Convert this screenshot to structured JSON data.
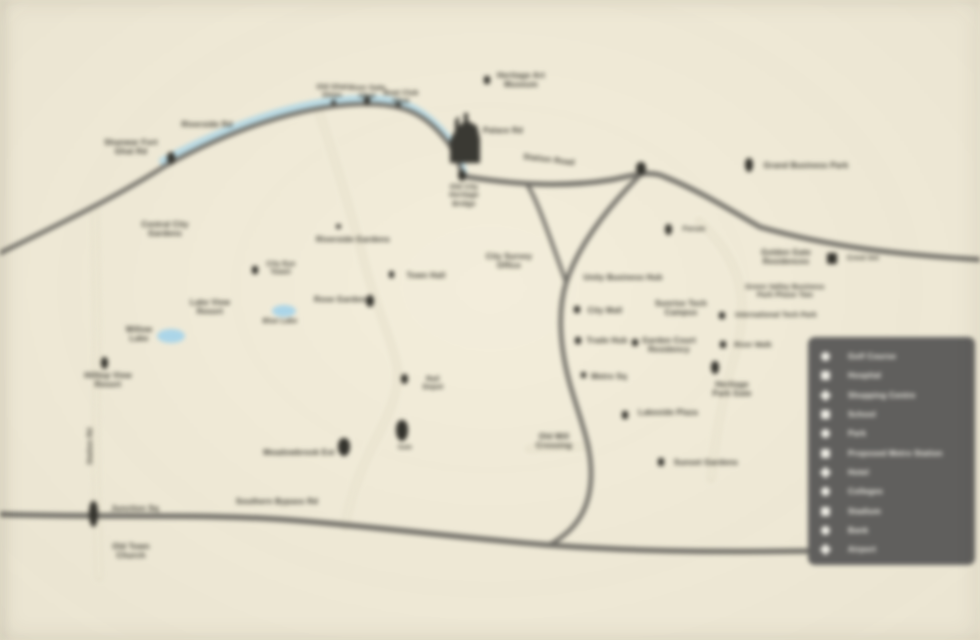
{
  "colors": {
    "background": "#f4eeda",
    "river": "#b9d9e3",
    "lake": "#abd5e8",
    "road_dark": "#716f68",
    "road_light_edge": "#ddd6c0",
    "road_light_core": "#f1ecd9",
    "ink": "#3c3b33",
    "marker": "#33322c",
    "building": "#3a3933",
    "legend_bg": "#605f5d",
    "legend_ink": "#f0eee6"
  },
  "map": {
    "note": "location map, all label text blurred/illegible in source",
    "lakes": [
      {
        "cx": 171,
        "cy": 336,
        "rx": 14,
        "ry": 7
      },
      {
        "cx": 284,
        "cy": 311,
        "rx": 12,
        "ry": 6
      }
    ],
    "labels": [
      {
        "cx": 131,
        "y": 138,
        "text": "Shanwar Fort\nGhat Rd"
      },
      {
        "cx": 207,
        "y": 120,
        "text": "Riverside Rd"
      },
      {
        "cx": 165,
        "y": 220,
        "text": "Central City\nGardens"
      },
      {
        "cx": 332,
        "y": 84,
        "text": "Old Ghat\nSteps",
        "size": 7
      },
      {
        "cx": 367,
        "y": 85,
        "text": "River Gate\nGhat",
        "size": 7
      },
      {
        "cx": 401,
        "y": 90,
        "text": "Boat Club\nGhat",
        "size": 7
      },
      {
        "cx": 521,
        "y": 71,
        "text": "Heritage Art\nMuseum"
      },
      {
        "cx": 503,
        "y": 126,
        "text": "Palace Rd"
      },
      {
        "cx": 464,
        "y": 184,
        "text": "Old City\nHeritage\nBridge",
        "size": 7
      },
      {
        "cx": 549,
        "y": 155,
        "text": "Station Road",
        "rot": 7
      },
      {
        "cx": 806,
        "y": 161,
        "text": "Grand Business Park"
      },
      {
        "cx": 509,
        "y": 252,
        "text": "City Survey\nOffice"
      },
      {
        "cx": 353,
        "y": 235,
        "text": "Riverside Gardens"
      },
      {
        "cx": 426,
        "y": 271,
        "text": "Town Hall"
      },
      {
        "cx": 340,
        "y": 295,
        "text": "Rose Garden"
      },
      {
        "cx": 210,
        "y": 298,
        "text": "Lake View\nResort"
      },
      {
        "cx": 139,
        "y": 325,
        "text": "Willow\nLake"
      },
      {
        "cx": 280,
        "y": 318,
        "text": "Blue Lake",
        "size": 7
      },
      {
        "cx": 108,
        "y": 371,
        "text": "Hilltop View\nResort"
      },
      {
        "cx": 623,
        "y": 273,
        "text": "Unity Business Hub"
      },
      {
        "cx": 605,
        "y": 306,
        "text": "City Mall"
      },
      {
        "cx": 607,
        "y": 336,
        "text": "Trade Hub"
      },
      {
        "cx": 669,
        "y": 336,
        "text": "Garden Court\nResidency"
      },
      {
        "cx": 681,
        "y": 299,
        "text": "Sunrise Tech\nCampus"
      },
      {
        "cx": 609,
        "y": 372,
        "text": "Metro Sq"
      },
      {
        "cx": 732,
        "y": 380,
        "text": "Heritage\nPark Gate"
      },
      {
        "cx": 785,
        "y": 284,
        "text": "Green Valley Business\nPark Phase Two",
        "size": 7
      },
      {
        "cx": 786,
        "y": 248,
        "text": "Golden Gate\nResidences"
      },
      {
        "cx": 863,
        "y": 255,
        "text": "Crest Inn",
        "size": 7
      },
      {
        "cx": 776,
        "y": 312,
        "text": "International Tech Park",
        "size": 7
      },
      {
        "cx": 753,
        "y": 342,
        "text": "River Walk",
        "size": 7
      },
      {
        "cx": 668,
        "y": 408,
        "text": "Lakeside Plaza"
      },
      {
        "cx": 706,
        "y": 458,
        "text": "Sunset Gardens"
      },
      {
        "cx": 554,
        "y": 432,
        "text": "Old Mill\nCrossing"
      },
      {
        "cx": 433,
        "y": 376,
        "text": "Rail\nDepot",
        "size": 7
      },
      {
        "cx": 405,
        "y": 445,
        "text": "Gate",
        "size": 6
      },
      {
        "cx": 299,
        "y": 448,
        "text": "Meadowbrook Est"
      },
      {
        "cx": 277,
        "y": 497,
        "text": "Southern Bypass Rd"
      },
      {
        "cx": 135,
        "y": 504,
        "text": "Junction Sq"
      },
      {
        "cx": 131,
        "y": 542,
        "text": "Old Town\nChurch"
      },
      {
        "cx": 91,
        "y": 442,
        "text": "Station Rd",
        "size": 7,
        "rot": -90
      },
      {
        "cx": 694,
        "y": 226,
        "text": "Forum",
        "size": 7
      },
      {
        "cx": 281,
        "y": 261,
        "text": "City Eye\nTower",
        "size": 7
      }
    ],
    "markers": [
      {
        "x": 167,
        "y": 152,
        "w": 8,
        "h": 12,
        "s": "pin"
      },
      {
        "x": 331,
        "y": 100,
        "w": 5,
        "h": 5,
        "s": "dot"
      },
      {
        "x": 364,
        "y": 96,
        "w": 6,
        "h": 9,
        "s": "pin"
      },
      {
        "x": 396,
        "y": 102,
        "w": 5,
        "h": 5,
        "s": "dot"
      },
      {
        "x": 484,
        "y": 76,
        "w": 6,
        "h": 8,
        "s": "sq"
      },
      {
        "x": 458,
        "y": 170,
        "w": 8,
        "h": 11,
        "s": "pin"
      },
      {
        "x": 636,
        "y": 162,
        "w": 10,
        "h": 13,
        "s": "pin"
      },
      {
        "x": 745,
        "y": 158,
        "w": 8,
        "h": 14,
        "s": "pin"
      },
      {
        "x": 827,
        "y": 253,
        "w": 10,
        "h": 11,
        "s": "sq"
      },
      {
        "x": 665,
        "y": 224,
        "w": 7,
        "h": 11,
        "s": "pin"
      },
      {
        "x": 574,
        "y": 306,
        "w": 6,
        "h": 7,
        "s": "sq"
      },
      {
        "x": 575,
        "y": 337,
        "w": 6,
        "h": 7,
        "s": "sq"
      },
      {
        "x": 632,
        "y": 339,
        "w": 6,
        "h": 7,
        "s": "sq"
      },
      {
        "x": 581,
        "y": 372,
        "w": 5,
        "h": 6,
        "s": "sq"
      },
      {
        "x": 711,
        "y": 361,
        "w": 8,
        "h": 13,
        "s": "pin"
      },
      {
        "x": 719,
        "y": 312,
        "w": 6,
        "h": 7,
        "s": "sq"
      },
      {
        "x": 720,
        "y": 341,
        "w": 6,
        "h": 7,
        "s": "sq"
      },
      {
        "x": 622,
        "y": 411,
        "w": 6,
        "h": 8,
        "s": "sq"
      },
      {
        "x": 658,
        "y": 458,
        "w": 6,
        "h": 8,
        "s": "sq"
      },
      {
        "x": 401,
        "y": 374,
        "w": 7,
        "h": 10,
        "s": "pin"
      },
      {
        "x": 396,
        "y": 420,
        "w": 12,
        "h": 21,
        "s": "pin"
      },
      {
        "x": 338,
        "y": 438,
        "w": 12,
        "h": 18,
        "s": "pin"
      },
      {
        "x": 89,
        "y": 501,
        "w": 9,
        "h": 26,
        "s": "pin"
      },
      {
        "x": 101,
        "y": 357,
        "w": 7,
        "h": 12,
        "s": "pin"
      },
      {
        "x": 366,
        "y": 295,
        "w": 8,
        "h": 12,
        "s": "pin"
      },
      {
        "x": 336,
        "y": 224,
        "w": 5,
        "h": 5,
        "s": "dot"
      },
      {
        "x": 389,
        "y": 271,
        "w": 5,
        "h": 7,
        "s": "sq"
      },
      {
        "x": 252,
        "y": 266,
        "w": 6,
        "h": 8,
        "s": "sq"
      }
    ]
  },
  "legend": {
    "items": [
      {
        "icon": "circle",
        "label": "Golf Course"
      },
      {
        "icon": "square",
        "label": "Hospital"
      },
      {
        "icon": "diamond",
        "label": "Shopping Centre"
      },
      {
        "icon": "square",
        "label": "School"
      },
      {
        "icon": "circle",
        "label": "Park"
      },
      {
        "icon": "square",
        "label": "Proposed Metro Station"
      },
      {
        "icon": "diamond",
        "label": "Hotel"
      },
      {
        "icon": "circle",
        "label": "Colleges"
      },
      {
        "icon": "square",
        "label": "Stadium"
      },
      {
        "icon": "circle",
        "label": "Bank"
      },
      {
        "icon": "diamond",
        "label": "Airport"
      }
    ]
  }
}
